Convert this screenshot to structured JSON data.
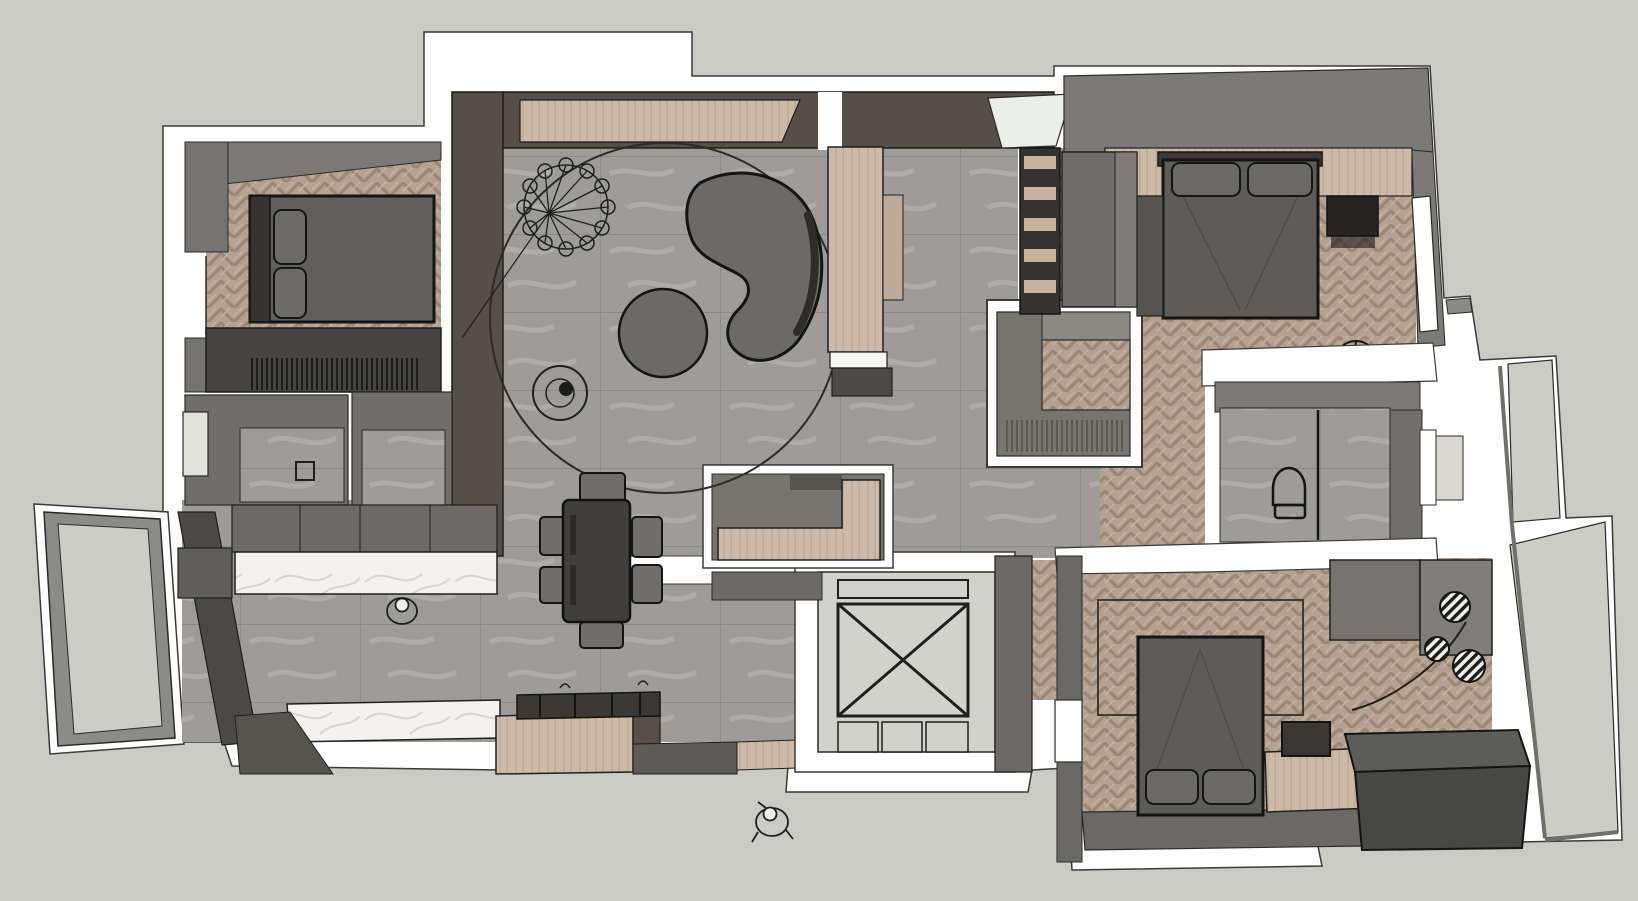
{
  "scene": {
    "type": "3d-floor-plan-top-view",
    "style": "sketchup-monochrome-render",
    "people_visible": 2,
    "rooms": [
      {
        "name": "bedroom-top-left",
        "floor": "herringbone-wood",
        "items": [
          "double-bed",
          "pillows",
          "wardrobe-hanging-clothes",
          "window"
        ]
      },
      {
        "name": "living-room",
        "floor": "gray-stone-tile",
        "items": [
          "kidney-sofa",
          "round-ottoman",
          "round-rug-outline",
          "wire-pendant-lamp",
          "side-table-vase",
          "tv-media-wall",
          "tall-wood-cabinet"
        ]
      },
      {
        "name": "dining-area",
        "floor": "gray-stone-tile",
        "items": [
          "dining-table",
          "six-chairs"
        ]
      },
      {
        "name": "kitchen",
        "floor": "gray-stone-tile",
        "items": [
          "marble-counter-top",
          "marble-counter-bottom",
          "island-gas-cooktop",
          "upper-cabinets",
          "wood-floor-strip"
        ]
      },
      {
        "name": "bathroom-left",
        "floor": "gray-stone-tile",
        "items": [
          "floor-drain",
          "window"
        ]
      },
      {
        "name": "shower-room-left",
        "floor": "gray-stone-tile",
        "items": []
      },
      {
        "name": "balcony-left",
        "floor": "light-gray-deck",
        "items": []
      },
      {
        "name": "entry-nook",
        "floor": "gray-stone-tile",
        "items": [
          "l-shaped-shoe-bench"
        ]
      },
      {
        "name": "elevator",
        "floor": "light-gray",
        "items": [
          "x-cross-marking",
          "door-panels"
        ]
      },
      {
        "name": "walk-in-closet",
        "floor": "herringbone-wood",
        "items": [
          "l-shaped-wardrobe"
        ]
      },
      {
        "name": "bedroom-top-right",
        "floor": "herringbone-wood",
        "items": [
          "double-bed",
          "pillows",
          "wood-headboard-band",
          "nightstand",
          "wardrobe",
          "bookshelf",
          "fan-stool",
          "window"
        ]
      },
      {
        "name": "bathroom-right",
        "floor": "gray-stone-tile",
        "items": [
          "toilet",
          "shower-divider",
          "window"
        ]
      },
      {
        "name": "bedroom-bottom-right",
        "floor": "herringbone-wood",
        "items": [
          "double-bed",
          "pillows",
          "desk",
          "stool",
          "storage-chest",
          "rug-outline",
          "rattan-pendant-lamps",
          "window"
        ]
      },
      {
        "name": "balcony-right",
        "floor": "light-gray-deck",
        "items": []
      },
      {
        "name": "hallway",
        "floor": "gray-stone-tile",
        "items": []
      }
    ]
  },
  "colors": {
    "background": "#cbcbc5",
    "wall_white": "#ffffff",
    "wall_gray": "#77767[2]",
    "wall_gray_light": "#8a8985",
    "wall_gray_mid": "#6a6965",
    "wall_gray_dark": "#4c4b48",
    "wood_dark": "#564f47",
    "wood_light": "#cbbaa7",
    "wood_floor": "#b3a191",
    "stone_floor": "#9d9c98",
    "marble": "#f3f2f0",
    "furniture_gray": "#615f5d",
    "furniture_dark": "#454443",
    "furniture_black": "#2a2927",
    "elevator_floor": "#d2d2cc",
    "balcony_floor": "#cdcdc7",
    "outline": "#1f1f1d"
  }
}
